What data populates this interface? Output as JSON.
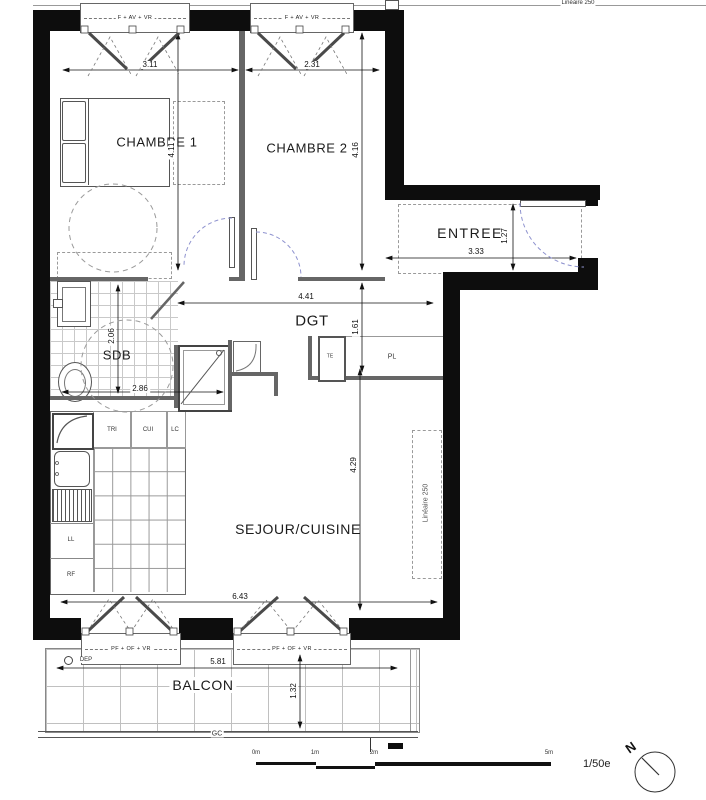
{
  "meta": {
    "scale_text": "1/50e",
    "compass_label": "N"
  },
  "rooms": {
    "chambre1": "CHAMBRE 1",
    "chambre2": "CHAMBRE 2",
    "entree": "ENTREE",
    "dgt": "DGT",
    "sdb": "SDB",
    "sejour": "SEJOUR/CUISINE",
    "balcon": "BALCON"
  },
  "closets": {
    "pl": "PL",
    "te": "TE"
  },
  "kitchen": {
    "tri": "TRI",
    "cui": "CUI",
    "lc": "LC",
    "ll": "LL",
    "rf": "RF"
  },
  "annotations": {
    "dep": "DEP",
    "gc": "GC",
    "lineaire": "Linéaire 250"
  },
  "windows": {
    "top": "F + AV + VR",
    "bottom": "PF + OF + VR"
  },
  "dimensions": {
    "ch1_w": "3.11",
    "ch2_w": "2.31",
    "ch1_h": "4.11",
    "ch2_h": "4.16",
    "entree_w": "3.33",
    "entree_h": "1.27",
    "dgt_w": "4.41",
    "dgt_h": "1.61",
    "sdb_w": "2.86",
    "sdb_h": "2.06",
    "sejour_h": "4.29",
    "sejour_w": "6.43",
    "balcon_w": "5.81",
    "balcon_h": "1.32"
  },
  "scalebar": {
    "m0": "0m",
    "m1": "1m",
    "m2": "2m",
    "m5": "5m"
  }
}
